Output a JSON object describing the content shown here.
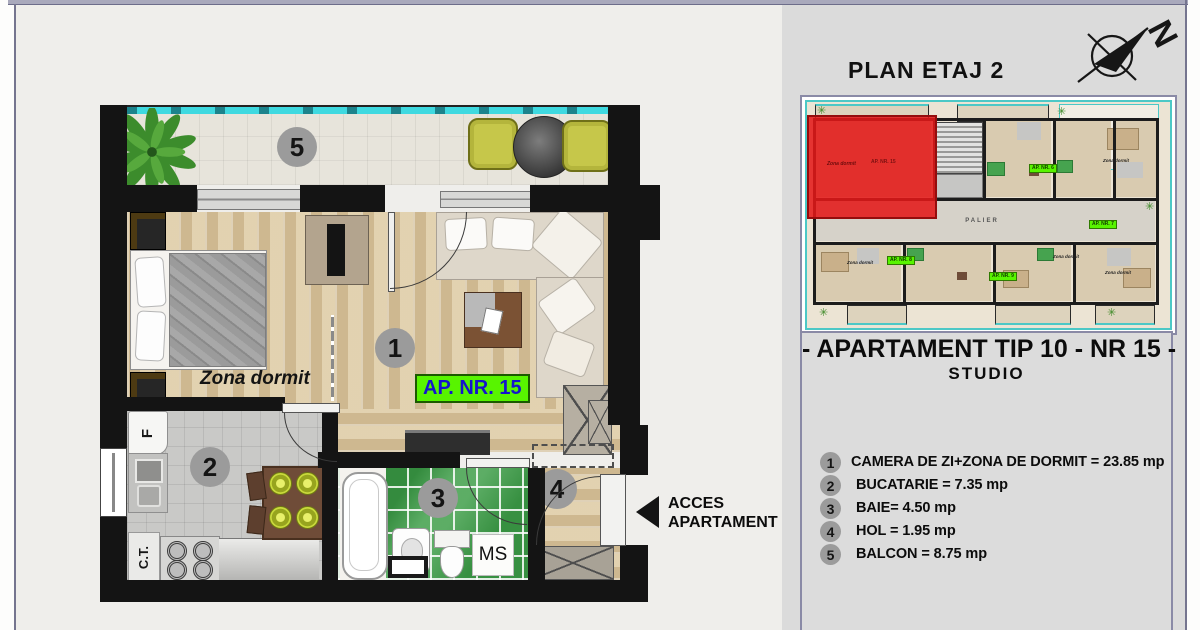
{
  "header": {
    "title": "PLAN ETAJ 2",
    "compass_letter": "N"
  },
  "floor_plan": {
    "rooms": {
      "living": "1",
      "kitchen": "2",
      "bath": "3",
      "hall": "4",
      "balcony": "5"
    },
    "zona_dormit_label": "Zona dormit",
    "apartment_tag": "AP. NR. 15",
    "ms_label": "MS",
    "fridge_label": "F",
    "boiler_label": "C.T.",
    "access_line1": "ACCES",
    "access_line2": "APARTAMENT"
  },
  "mini_plan": {
    "palier_label": "PALIER",
    "ap6_label": "AP. NR. 6",
    "ap7_label": "AP. NR. 7",
    "ap8_label": "AP. NR. 8",
    "ap9_label": "AP. NR. 9",
    "red_zona_label": "Zona dormit",
    "red_unit_label": "AP. NR. 15",
    "zona_labels": [
      "Zona dormit",
      "Zona dormit",
      "Zona dormit",
      "Zona dormit"
    ]
  },
  "info": {
    "apartment_title": "- APARTAMENT TIP 10 - NR 15 -",
    "apartment_subtitle": "STUDIO",
    "legend": [
      {
        "num": "1",
        "text": "CAMERA DE ZI+ZONA DE DORMIT = 23.85 mp"
      },
      {
        "num": "2",
        "text": "BUCATARIE = 7.35 mp"
      },
      {
        "num": "3",
        "text": "BAIE= 4.50 mp"
      },
      {
        "num": "4",
        "text": "HOL = 1.95 mp"
      },
      {
        "num": "5",
        "text": "BALCON = 8.75 mp"
      }
    ]
  },
  "colors": {
    "accent_green": "#58f400",
    "accent_blue": "#1515cd",
    "highlight_red": "#e31f1f",
    "bath_green": "#42a04c",
    "glass_cyan": "#3fd9e0"
  }
}
